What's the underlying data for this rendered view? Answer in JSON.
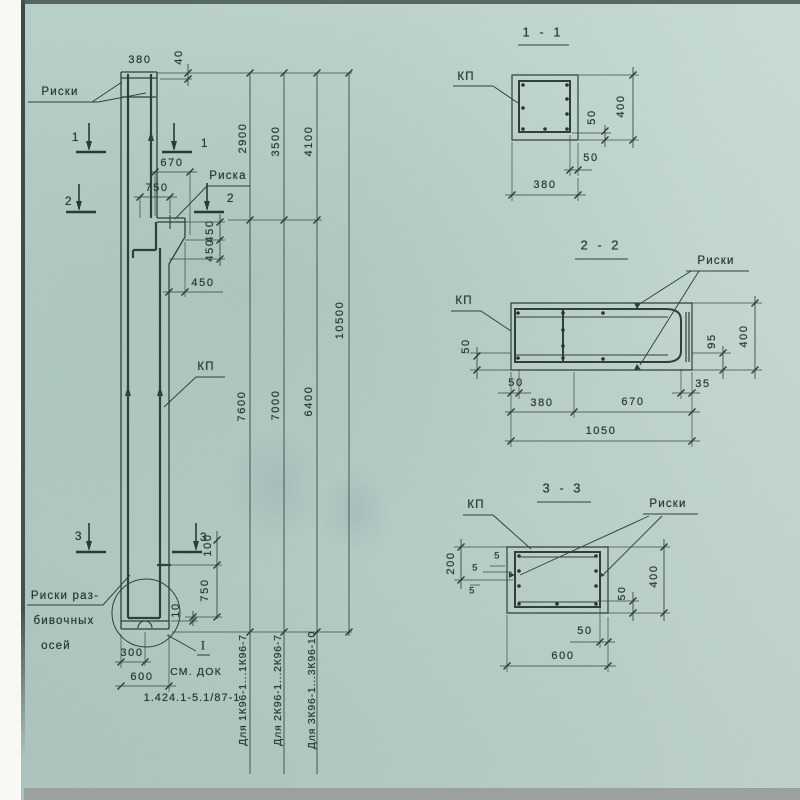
{
  "palette": {
    "paper": "#bcd2cc",
    "ink": "#2b3a37",
    "margin": "#f8f8f4",
    "scan_strip": "#9ba19e"
  },
  "elevation": {
    "riski_label": "Риски",
    "riska_label": "Риска",
    "kp_label": "КП",
    "axes_note": [
      "Риски раз-",
      "бивочных",
      "осей"
    ],
    "see_doc": "СМ. ДОК",
    "node_ref": "I",
    "doc_series": "1.424.1-5.1/87-1",
    "marks": {
      "s1": "1",
      "s2": "2",
      "s3": "3"
    },
    "dims": {
      "top_width": "380",
      "top_offset": "40",
      "corbel_w": "670",
      "corbel_mark": "750",
      "corbel_h1": "450",
      "corbel_h2": "450",
      "corbel_face": "450",
      "upper_len_1": "2900",
      "upper_len_2": "3500",
      "upper_len_3": "4100",
      "total_len": "10500",
      "lower_len_1": "7600",
      "lower_len_2": "7000",
      "lower_len_3": "6400",
      "base_mark_offset": "100",
      "base_mark": "750",
      "base_gap": "10",
      "base_half": "300",
      "base_width": "600"
    },
    "applicability": [
      "Для 1К96-1...1К96-7",
      "Для 2К96-1...2К96-7",
      "Для 3К96-1...3К96-10"
    ]
  },
  "section_1_1": {
    "title": "1 - 1",
    "kp_label": "КП",
    "dims": {
      "cover_v": "50",
      "height": "400",
      "cover_h": "50",
      "width": "380"
    }
  },
  "section_2_2": {
    "title": "2 - 2",
    "kp_label": "КП",
    "riski_label": "Риски",
    "dims": {
      "cover_left": "50",
      "plate_offset": "95",
      "height": "400",
      "cover_bottom": "50",
      "edge": "35",
      "col_width": "380",
      "corbel_width": "670",
      "total_width": "1050"
    }
  },
  "section_3_3": {
    "title": "3 - 3",
    "kp_label": "КП",
    "riski_label": "Риски",
    "dims": {
      "mark_offset": "200",
      "off_1": "5",
      "off_2": "5",
      "off_3": "5",
      "cover_right": "50",
      "height": "400",
      "cover_bottom": "50",
      "width": "600"
    }
  }
}
